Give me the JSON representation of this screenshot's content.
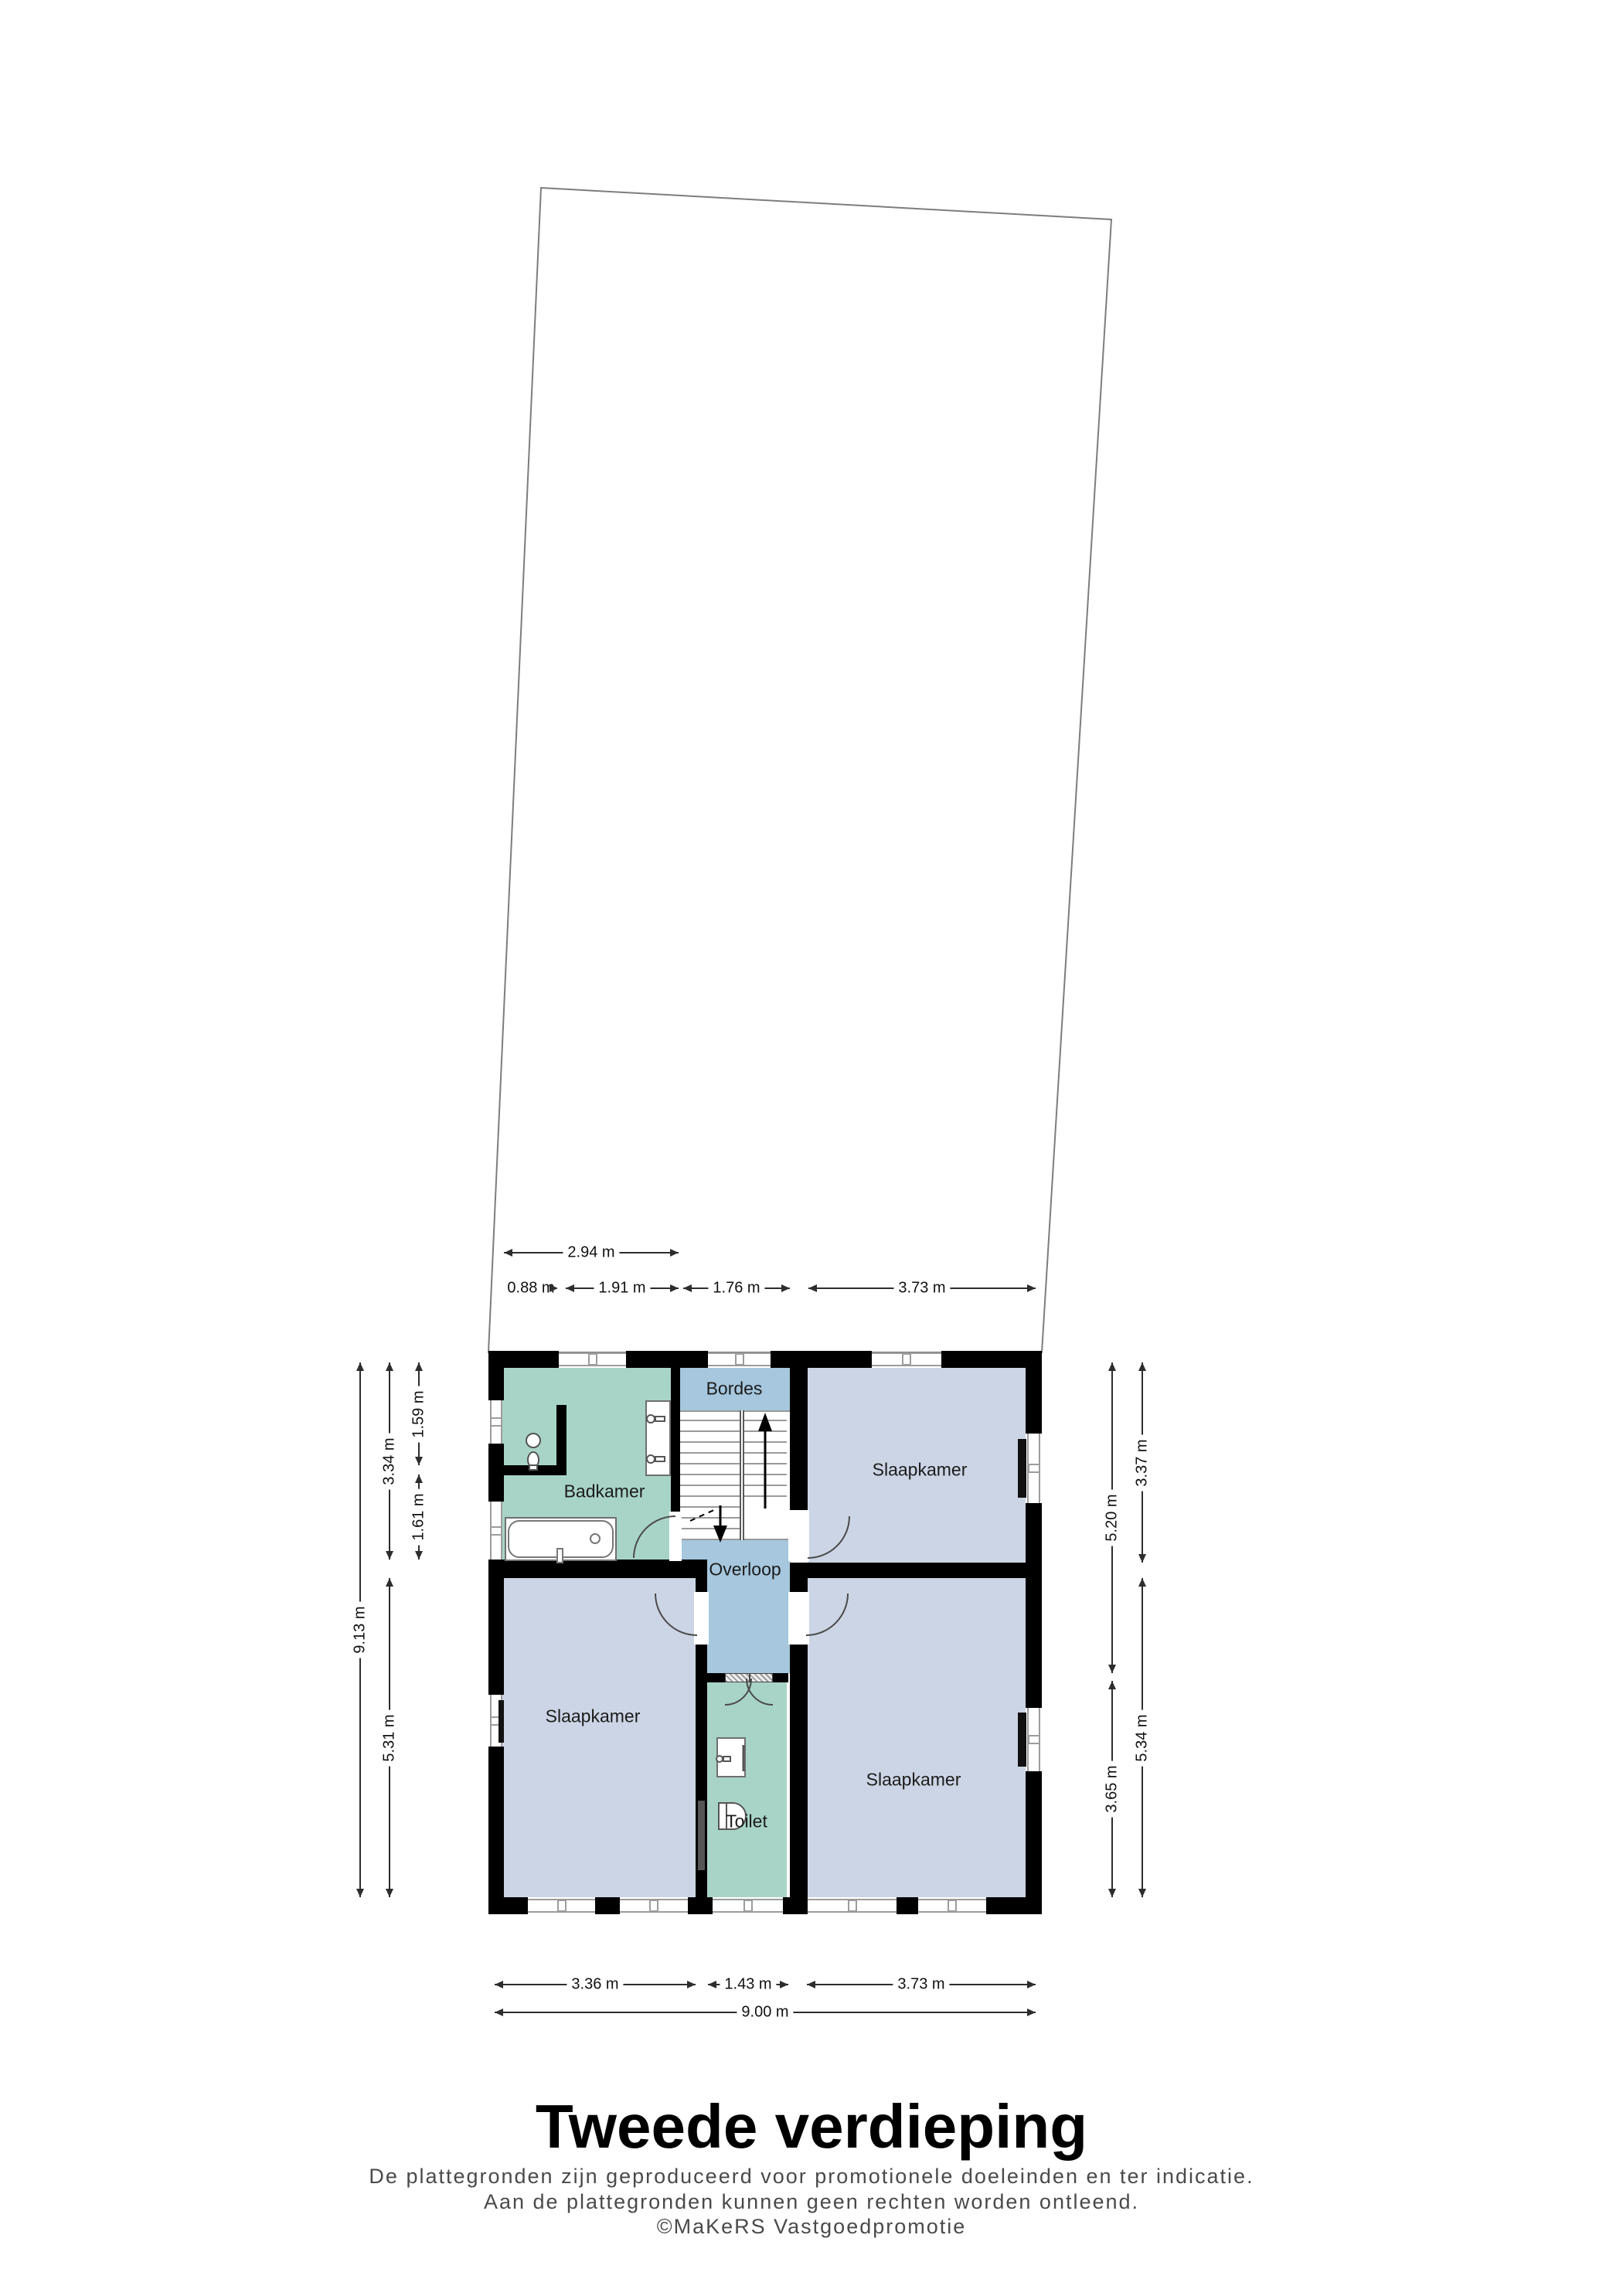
{
  "page": {
    "title": "Tweede verdieping",
    "disclaimer": [
      "De plattegronden zijn geproduceerd voor promotionele doeleinden en ter indicatie.",
      "Aan de plattegronden kunnen geen rechten worden ontleend.",
      "©MaKeRS Vastgoedpromotie"
    ]
  },
  "rooms": [
    {
      "id": "badkamer",
      "label": "Badkamer"
    },
    {
      "id": "bordes",
      "label": "Bordes"
    },
    {
      "id": "overloop",
      "label": "Overloop"
    },
    {
      "id": "slaapkamer-top-right",
      "label": "Slaapkamer"
    },
    {
      "id": "slaapkamer-bottom-left",
      "label": "Slaapkamer"
    },
    {
      "id": "slaapkamer-bottom-right",
      "label": "Slaapkamer"
    },
    {
      "id": "toilet",
      "label": "Toilet"
    }
  ],
  "dimensions": {
    "top": [
      "2.94 m",
      "0.88 m",
      "1.91 m",
      "1.76 m",
      "3.73 m"
    ],
    "left": [
      "9.13 m",
      "3.34 m",
      "5.31 m",
      "1.59 m",
      "1.61 m"
    ],
    "right": [
      "5.20 m",
      "3.65 m",
      "3.37 m",
      "5.34 m"
    ],
    "bottom": [
      "3.36 m",
      "1.43 m",
      "3.73 m",
      "9.00 m"
    ]
  },
  "colors": {
    "wall": "#000000",
    "wet_room": "#a8d4c7",
    "hall": "#a6c7dd",
    "bedroom": "#ccd5e5",
    "plot_outline": "#7d7d7d"
  }
}
